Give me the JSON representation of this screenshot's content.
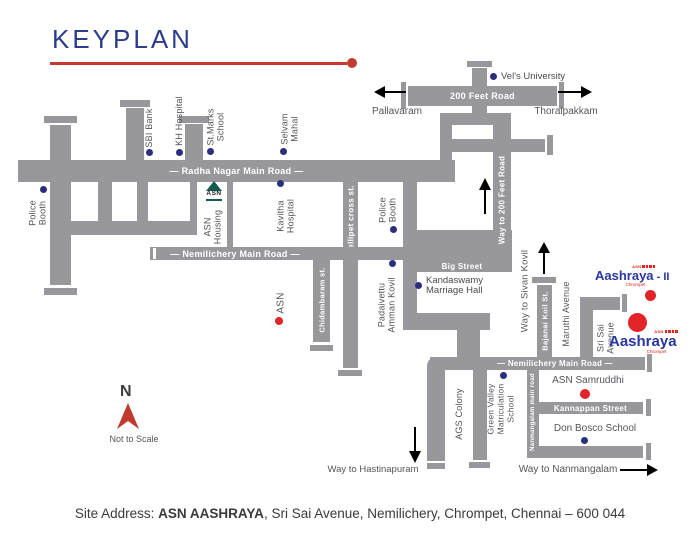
{
  "title": "KEYPLAN",
  "roads": {
    "radha_nagar": "— Radha Nagar Main Road —",
    "nemilichery_upper": "— Nemilichery Main Road —",
    "nemilichery_lower": "— Nemilichery Main Road —",
    "feet200": "200 Feet Road",
    "big_street": "Big Street",
    "kannappan": "Kannappan Street",
    "nellipet": "Nellipet cross st.",
    "way_200": "Way to 200 Feet Road",
    "chidambaram": "Chidambaram st.",
    "bajanai": "Bajanai Koil St.",
    "nanmangalam_main": "Nanmangalam main road"
  },
  "places": {
    "vels": "Vel's University",
    "pallavaram": "Pallavaram",
    "thoraipakkam": "Thoraipakkam",
    "sbi": "SBI Bank",
    "kh": "KH Hospital",
    "st_marks": "St.Marks\nSchool",
    "selvam": "Selvam\nMahal",
    "police": "Police\nBooth",
    "asn_housing": "ASN\nHousing",
    "kavitha": "Kavitha\nHospital",
    "asn_site": "ASN",
    "padaivettu": "Padaivettu\nAmman Kovil",
    "kandaswamy": "Kandaswamy\nMarriage Hall",
    "way_sivan": "Way to Sivan Kovil",
    "maruthi": "Maruthi Avenue",
    "sri_sai": "Sri Sai\nAvenue",
    "ags": "AGS Colony",
    "green_valley": "Green Valley\nMatriculation\nSchool",
    "samruddhi": "ASN Samruddhi",
    "don_bosco": "Don Bosco School",
    "way_hastinapuram": "Way to Hastinapuram",
    "way_nanmangalam": "Way to Nanmangalam"
  },
  "logos": {
    "aashraya": "Aashraya",
    "aashraya_ii_suffix": " - II",
    "chrompet": "Chrompet",
    "asn_small": "ASN",
    "asn_housing_mark": "ASN"
  },
  "compass": {
    "north": "N",
    "scale_note": "Not to Scale"
  },
  "address": {
    "label": "Site Address: ",
    "name": "ASN AASHRAYA",
    "rest": ", Sri Sai Avenue, Nemilichery, Chrompet, Chennai – 600 044"
  },
  "colors": {
    "road_gray": "#98979c",
    "title_blue": "#2b3d8c",
    "accent_red": "#c23b31",
    "marker_navy": "#2b2e7e",
    "marker_red": "#e02428",
    "logo_blue": "#2936a0",
    "logo_red": "#e2231a"
  }
}
